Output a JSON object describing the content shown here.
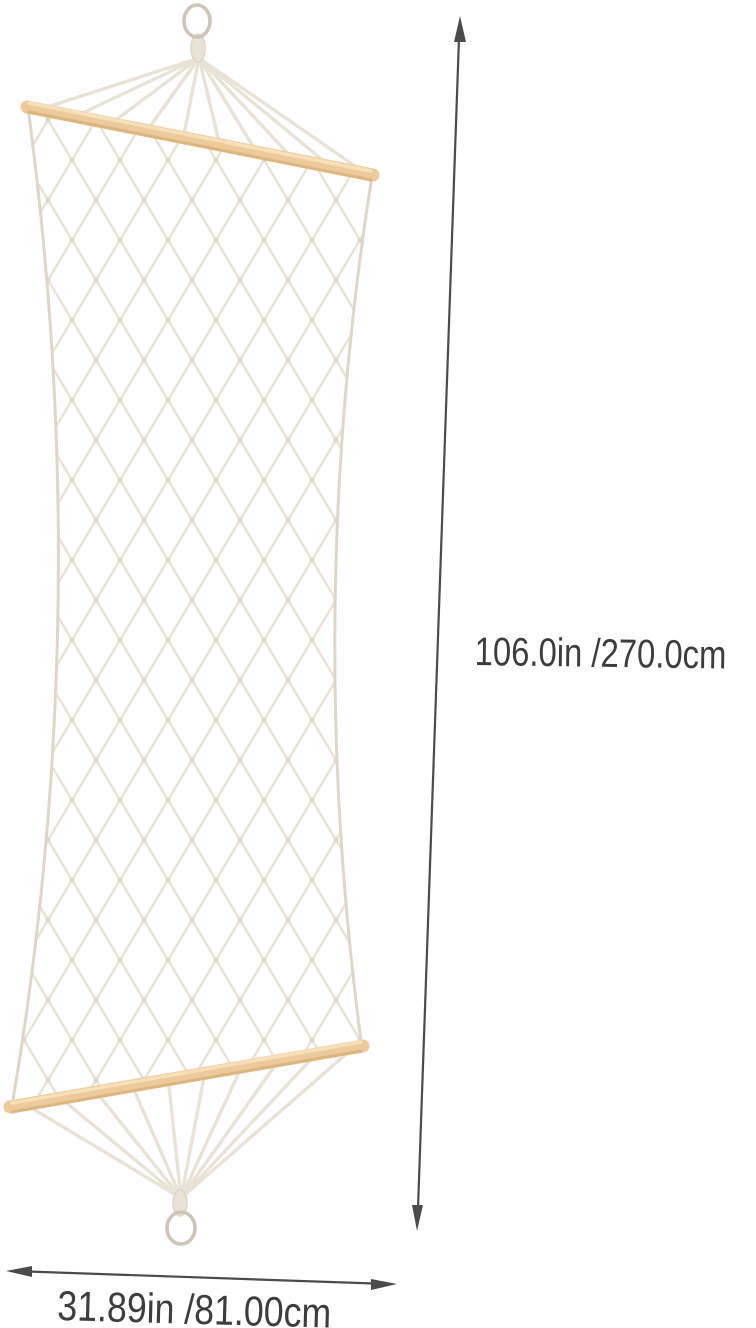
{
  "image": {
    "description": "White cotton rope net hammock hanging vertically from a metal ring, with two wooden spreader bars and a bottom metal ring, annotated with overall dimensions"
  },
  "annotations": {
    "height_label": "106.0in /270.0cm",
    "width_label": "31.89in /81.00cm"
  },
  "colors": {
    "background": "#ffffff",
    "rope": "#e9e3d7",
    "rope_edge": "#ded7c8",
    "rope_knot": "#ddd5c5",
    "wood": "#ecca9b",
    "wood_highlight": "#f6e2bd",
    "wood_shadow": "#d8ae74",
    "ring_metal": "#ccc5b8",
    "dimension_line": "#4b4b4b",
    "label_text": "#3d3d3d"
  }
}
